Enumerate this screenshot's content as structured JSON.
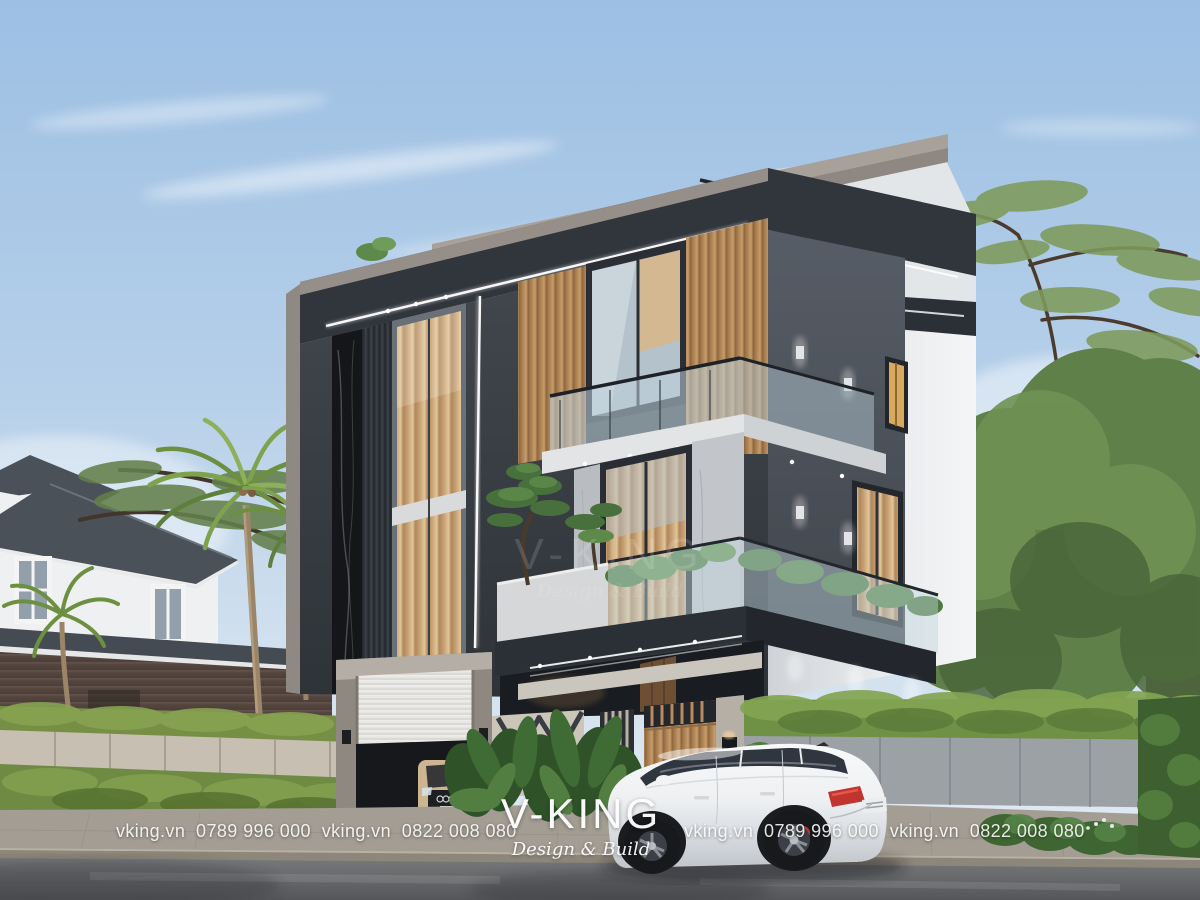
{
  "scene": {
    "alt": "Photorealistic exterior render of a modern three-storey villa with charcoal frames, wood slats, glass balconies, front fence, garage and a white SUV parked on the street"
  },
  "branding": {
    "watermark_line": "vking.vn  0789 996 000  vking.vn  0822 008 080",
    "logo": {
      "title": "V-KING",
      "subtitle": "Design & Build"
    },
    "watermark_center": {
      "title": "V-KING",
      "subtitle": "Design & Build"
    }
  },
  "colors": {
    "sky_top": "#9cbfe3",
    "sky_horizon": "#e6edf4",
    "charcoal_frame": "#31363d",
    "fascia_taupe": "#968f89",
    "white_wall": "#f0f2f4",
    "side_wall_gray": "#545a62",
    "wood_slats": "#b8905f",
    "warm_curtain": "#d2ac7c",
    "glass_tint": "#b9cdd8",
    "stone_cladding": "#bfc2c6",
    "black_marble": "#141619",
    "hedge_green": "#7d9c4a",
    "tree_green": "#5f8049",
    "fence_gray": "#9ca1a6",
    "fence_beige": "#c7bfb1",
    "road_asphalt": "#6e7072",
    "sidewalk": "#a49d93",
    "car_white": "#f6f7f9",
    "brake_red": "#c2342e",
    "led_white": "#ffffff"
  }
}
